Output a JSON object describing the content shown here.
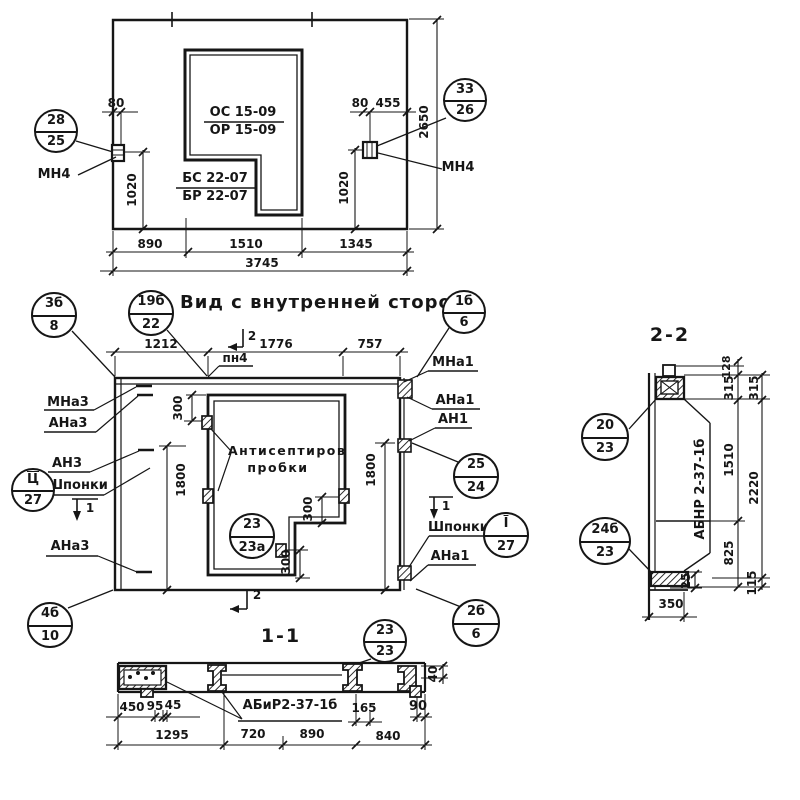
{
  "sheet": {
    "plan": {
      "callout_left": {
        "top": "28",
        "bottom": "25"
      },
      "callout_right": {
        "top": "33",
        "bottom": "26"
      },
      "anchor_left": "МН4",
      "anchor_right": "МН4",
      "mark_os": "ОС 15-09",
      "mark_or": "ОР 15-09",
      "mark_bs": "БС 22-07",
      "mark_br": "БР 22-07",
      "dims": {
        "d80l": "80",
        "d80r": "80",
        "d455": "455",
        "d1020l": "1020",
        "d1020r": "1020",
        "d2650": "2650",
        "d890": "890",
        "d1510": "1510",
        "d1345": "1345",
        "d3745": "3745"
      }
    },
    "view": {
      "title": "Вид с внутренней стороны",
      "pn4": "пн4",
      "note1": "Антисептиров",
      "note2": "пробки",
      "shponki_left": "Шпонки",
      "shponki_right": "Шпонки",
      "labels_left": {
        "mna3": "МНа3",
        "ana3_top": "АНа3",
        "an3": "АН3",
        "ana3_bottom": "АНа3"
      },
      "labels_right": {
        "mna1": "МНа1",
        "ana1_top": "АНа1",
        "an1": "АН1",
        "ana1_bottom": "АНа1"
      },
      "sec1": "1",
      "sec2": "2",
      "callouts": {
        "c3b8": {
          "top": "3б",
          "bottom": "8"
        },
        "c19b22": {
          "top": "19б",
          "bottom": "22"
        },
        "c1b6": {
          "top": "1б",
          "bottom": "6"
        },
        "c_ts27": {
          "top": "Ц",
          "bottom": "27"
        },
        "c4b10": {
          "top": "4б",
          "bottom": "10"
        },
        "c2323a": {
          "top": "23",
          "bottom": "23а"
        },
        "c2524": {
          "top": "25",
          "bottom": "24"
        },
        "c_i27": {
          "top": "I",
          "bottom": "27"
        },
        "c2b6": {
          "top": "2б",
          "bottom": "6"
        }
      },
      "dims": {
        "d1212": "1212",
        "d1776": "1776",
        "d757": "757",
        "d1800l": "1800",
        "d1800r": "1800",
        "d300t": "300",
        "d300m": "300",
        "d300b": "300"
      }
    },
    "section11": {
      "title": "1-1",
      "callout": {
        "top": "23",
        "bottom": "23"
      },
      "product": "АБиР2-37-1б",
      "dims": {
        "d450": "450",
        "d95": "95",
        "d45": "45",
        "d1295": "1295",
        "d720": "720",
        "d890": "890",
        "d165": "165",
        "d840": "840",
        "d90": "90",
        "d40": "40"
      }
    },
    "section22": {
      "title": "2-2",
      "callout_top": {
        "top": "20",
        "bottom": "23"
      },
      "callout_bottom": {
        "top": "24б",
        "bottom": "23"
      },
      "product": "АБНР 2-37-1б",
      "dims": {
        "d128": "128",
        "d315i": "315",
        "d315o": "315",
        "d1510": "1510",
        "d2220": "2220",
        "d825": "825",
        "d115": "115",
        "d25": "25",
        "d350": "350"
      }
    }
  }
}
